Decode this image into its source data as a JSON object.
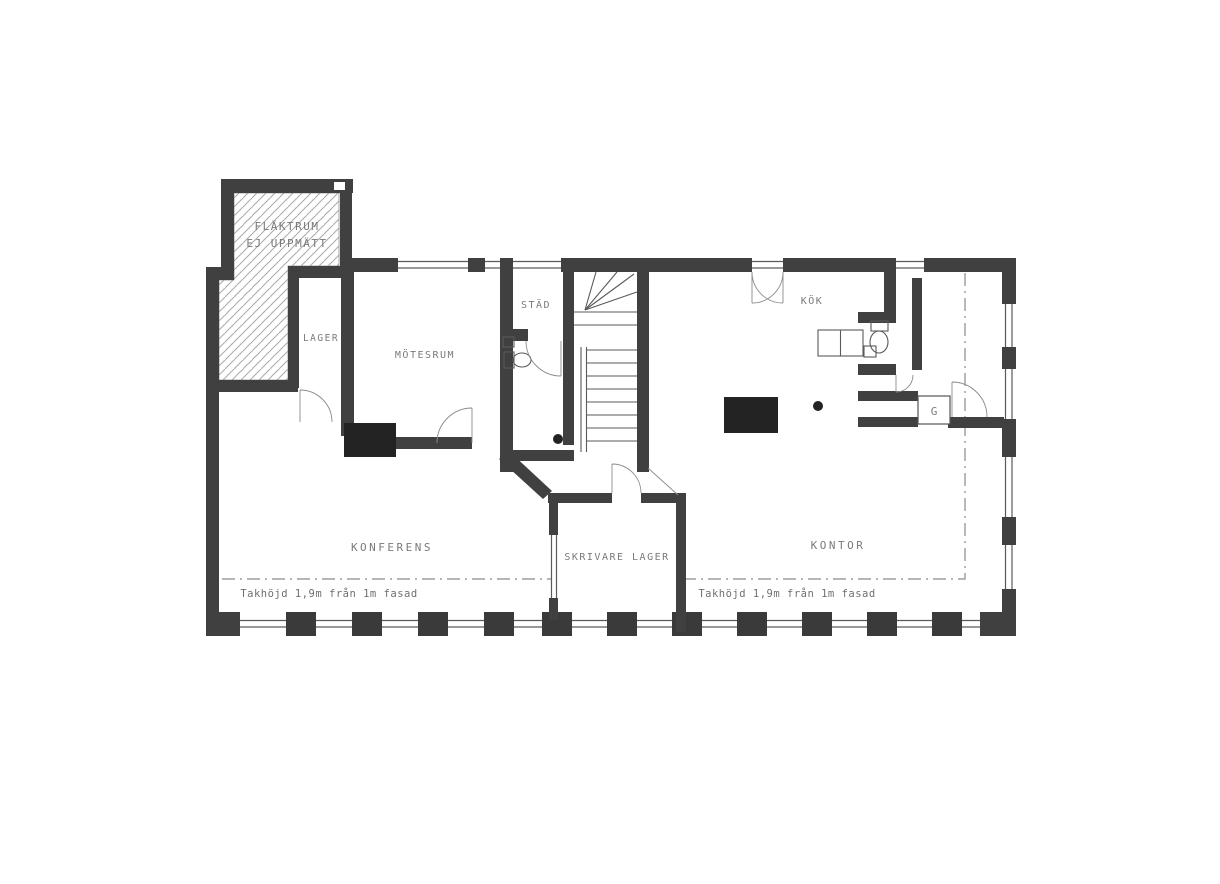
{
  "document": {
    "type": "scanned architectural floor plan",
    "language": "Swedish",
    "background_color": "#ffffff",
    "wall_color": "#404040",
    "pillar_color": "#222222",
    "text_color": "#7a7a7a"
  },
  "rooms": [
    {
      "id": "flaktrum-line1",
      "label": "FLÄKTRUM"
    },
    {
      "id": "flaktrum-line2",
      "label": "EJ UPPMÄTT"
    },
    {
      "id": "lager",
      "label": "LAGER"
    },
    {
      "id": "motesrum",
      "label": "MÖTESRUM"
    },
    {
      "id": "stad",
      "label": "STÄD"
    },
    {
      "id": "kok",
      "label": "KÖK"
    },
    {
      "id": "garderob",
      "label": "G"
    },
    {
      "id": "konferens",
      "label": "KONFERENS"
    },
    {
      "id": "skrivare-lager",
      "label": "SKRIVARE LAGER"
    },
    {
      "id": "kontor",
      "label": "KONTOR"
    }
  ],
  "annotations": [
    {
      "id": "ceiling-height-left",
      "label": "Takhöjd 1,9m från 1m fasad"
    },
    {
      "id": "ceiling-height-right",
      "label": "Takhöjd 1,9m från 1m fasad"
    }
  ]
}
